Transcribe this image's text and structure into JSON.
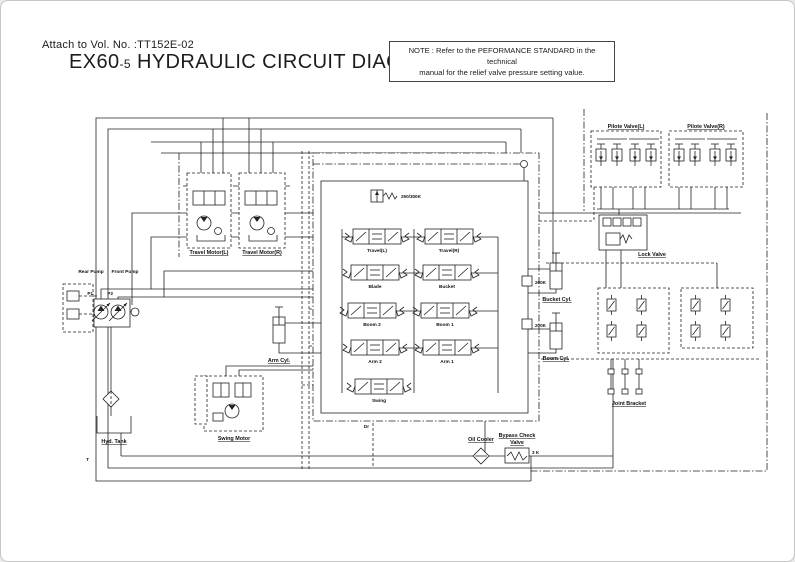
{
  "header": {
    "attach_line": "Attach to Vol. No. :TT152E-02",
    "title_model": "EX60",
    "title_suffix": "-5",
    "title_text": " HYDRAULIC CIRCUIT DIAGRAM"
  },
  "note": {
    "prefix": "NOTE :",
    "line1": "Refer to the PEFORMANCE STANDARD in the technical",
    "line2": "manual for the relief valve pressure setting value."
  },
  "components": {
    "travel_motor_l": "Travel Motor(L)",
    "travel_motor_r": "Travel Motor(R)",
    "rear_pump": "Rear Pump",
    "front_pump": "Front Pump",
    "hyd_tank": "Hyd. Tank",
    "swing_motor": "Swing Motor",
    "pilot_valve_l": "Pilote Valve(L)",
    "pilot_valve_r": "Pilote Valve(R)",
    "lock_valve": "Lock Valve",
    "joint_bracket": "Joint Bracket",
    "oil_cooler": "Oil Cooler",
    "bypass_valve_line1": "Bypass Check",
    "bypass_valve_line2": "Valve",
    "bypass_rating": "3 K",
    "bucket_cyl": "Bucket Cyl.",
    "boom_cyl": "Boom Cyl.",
    "arm_cyl": "Arm Cyl.",
    "main_relief_setting": "250/300K",
    "port_relief_setting_1": "200K",
    "port_relief_setting_2": "200K"
  },
  "spools": {
    "travel_l": "Travel(L)",
    "travel_r": "Travel(R)",
    "blade": "Blade",
    "bucket": "Bucket",
    "boom2": "Boom 2",
    "boom1": "Boom 1",
    "arm2": "Arm 2",
    "arm1": "Arm 1",
    "swing": "Swing"
  },
  "ports": {
    "p1": "P1",
    "p2": "P2",
    "t": "T",
    "dr": "Dr"
  }
}
